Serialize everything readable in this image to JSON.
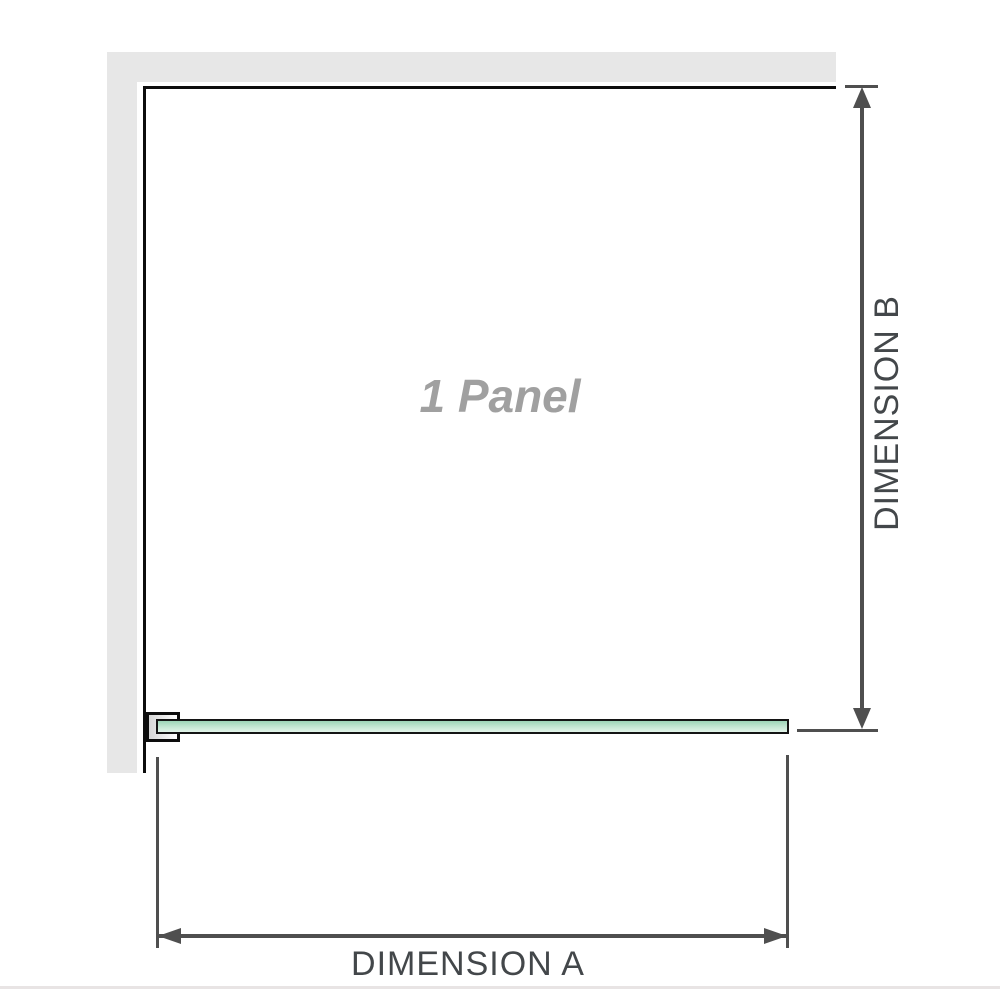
{
  "diagram": {
    "panel_label": "1 Panel",
    "dimension_a_label": "DIMENSION A",
    "dimension_b_label": "DIMENSION B"
  },
  "colors": {
    "wall": "#e7e7e7",
    "frame": "#0d0d0d",
    "glass_top": "#9dd4b6",
    "glass_bottom": "#e2f4e9",
    "glass_border": "#141414",
    "arrow": "#4f4f4f",
    "label_text": "#43474a",
    "panel_text": "#a0a0a0",
    "bottom_rule": "#e8e4e4"
  }
}
